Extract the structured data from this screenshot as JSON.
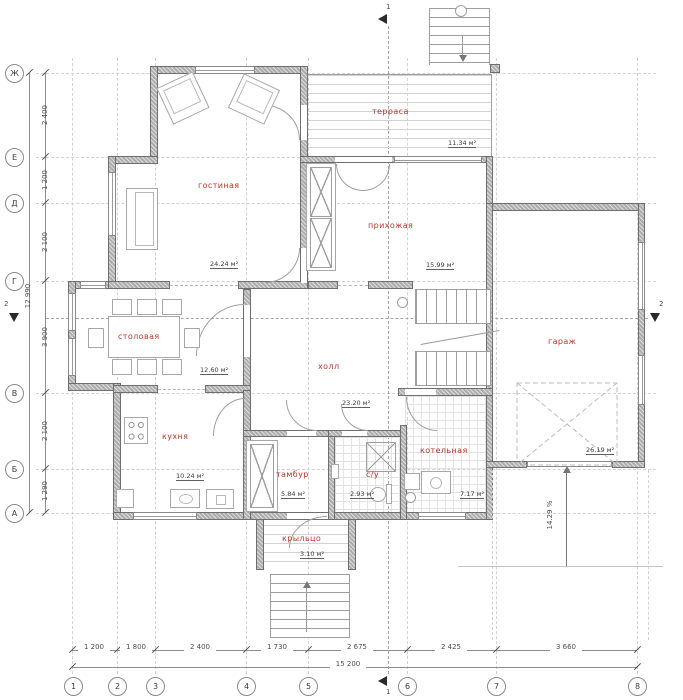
{
  "rooms": [
    {
      "name": "терраса",
      "area": "11.34 м²"
    },
    {
      "name": "гостиная",
      "area": "24.24 м²"
    },
    {
      "name": "прихожая",
      "area": "15.99 м²"
    },
    {
      "name": "столовая",
      "area": "12.60 м²"
    },
    {
      "name": "холл",
      "area": "23.20 м²"
    },
    {
      "name": "кухня",
      "area": "10.24 м²"
    },
    {
      "name": "тамбур",
      "area": "5.84 м²"
    },
    {
      "name": "с/у",
      "area": "2.93 м²"
    },
    {
      "name": "котельная",
      "area": "7.17 м²"
    },
    {
      "name": "гараж",
      "area": "26.19 м²"
    },
    {
      "name": "крыльцо",
      "area": "3.10 м²"
    }
  ],
  "grid": {
    "row_labels": [
      "Ж",
      "Е",
      "Д",
      "Г",
      "В",
      "Б",
      "А"
    ],
    "col_labels": [
      "1",
      "2",
      "3",
      "4",
      "5",
      "6",
      "7",
      "8"
    ],
    "row_dims": [
      "2 400",
      "1 200",
      "2 100",
      "3 900",
      "2 100",
      "1 290"
    ],
    "row_total": "12 990",
    "col_dims": [
      "1 200",
      "1 800",
      "2 400",
      "1 730",
      "2 675",
      "2 425",
      "3 660"
    ],
    "col_total": "15 200"
  },
  "annotations": {
    "slope": "14.29 %",
    "section_1": "1",
    "section_2": "2"
  },
  "colors": {
    "room_label": "#b23a2e",
    "wall_fill": "#aeaeae",
    "line": "#8d8d8d"
  }
}
